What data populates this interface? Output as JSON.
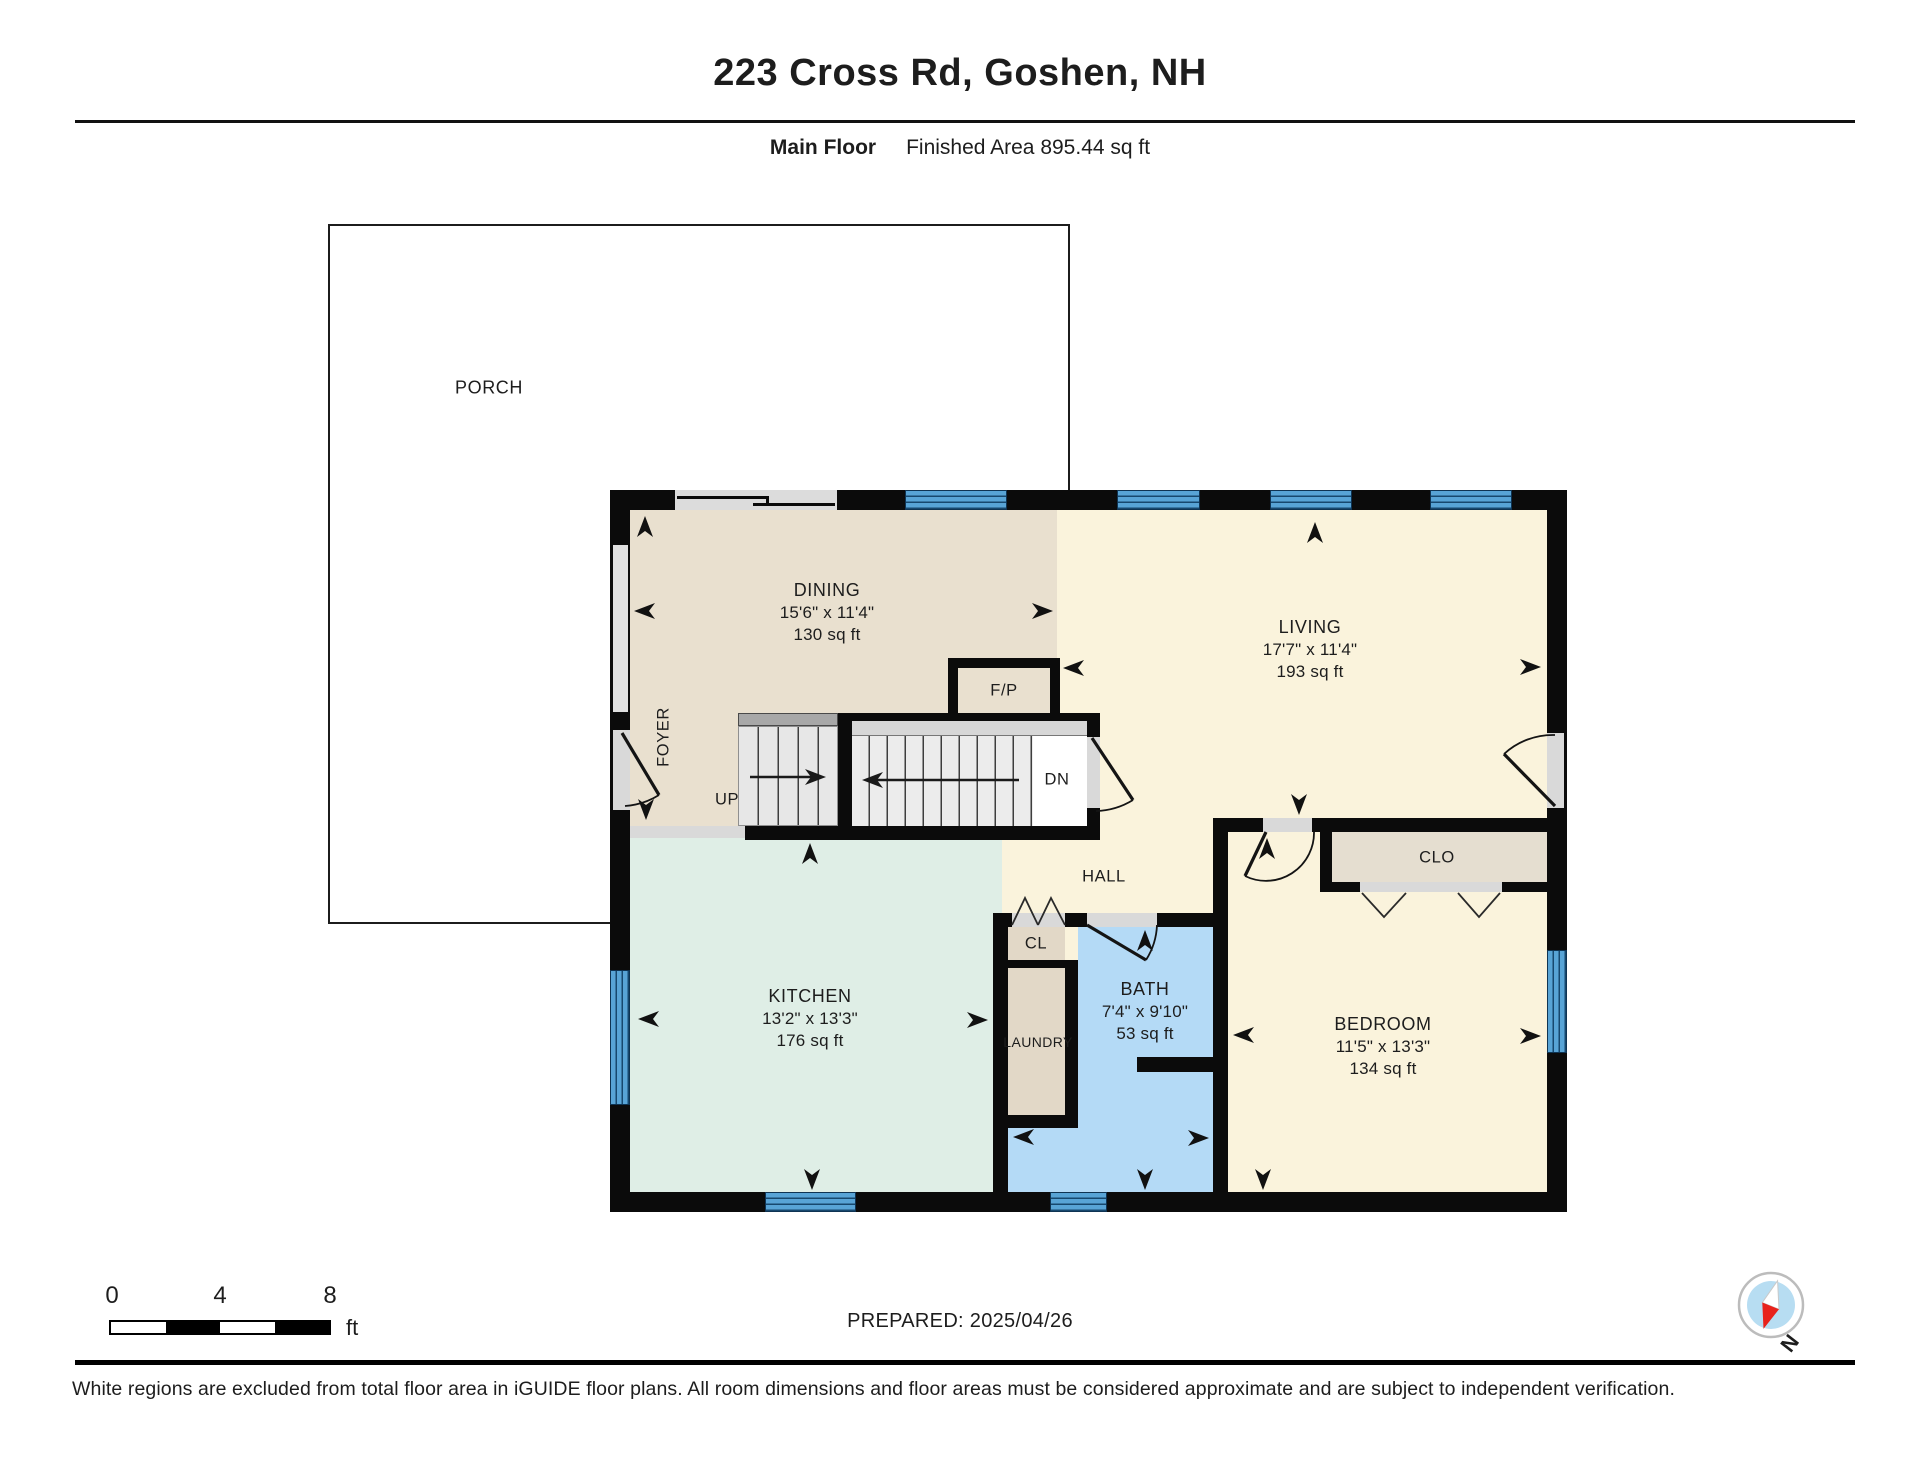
{
  "header": {
    "title": "223 Cross Rd, Goshen, NH",
    "floor_label": "Main Floor",
    "area_label": "Finished Area 895.44 sq ft"
  },
  "rooms": {
    "porch": {
      "name": "PORCH"
    },
    "dining": {
      "name": "DINING",
      "dims": "15'6\" x 11'4\"",
      "area": "130 sq ft"
    },
    "living": {
      "name": "LIVING",
      "dims": "17'7\" x 11'4\"",
      "area": "193 sq ft"
    },
    "kitchen": {
      "name": "KITCHEN",
      "dims": "13'2\" x 13'3\"",
      "area": "176 sq ft"
    },
    "bath": {
      "name": "BATH",
      "dims": "7'4\" x 9'10\"",
      "area": "53 sq ft"
    },
    "bedroom": {
      "name": "BEDROOM",
      "dims": "11'5\" x 13'3\"",
      "area": "134 sq ft"
    },
    "foyer": {
      "name": "FOYER"
    },
    "hall": {
      "name": "HALL"
    },
    "laundry": {
      "name": "LAUNDRY"
    },
    "closet_hall": {
      "name": "CL"
    },
    "closet_bedroom": {
      "name": "CLO"
    },
    "fireplace": {
      "name": "F/P"
    },
    "stairs_up": {
      "name": "UP"
    },
    "stairs_down": {
      "name": "DN"
    }
  },
  "scale_bar": {
    "tick0": "0",
    "tick4": "4",
    "tick8": "8",
    "unit": "ft"
  },
  "compass": {
    "north_label": "N"
  },
  "footer": {
    "prepared": "PREPARED: 2025/04/26",
    "disclaimer": "White regions are excluded from total floor area in iGUIDE floor plans. All room dimensions and floor areas must be considered approximate and are subject to independent verification."
  },
  "colors": {
    "dining_beige": "#e9e0cf",
    "living_cream": "#faf3dc",
    "kitchen_mint": "#dfeee6",
    "bath_blue": "#b4daf6",
    "closet_tan": "#e2d8c7",
    "clo_tan": "#e5ded0",
    "window_blue": "#58a4d6",
    "wall_black": "#0b0b0b",
    "compass_red": "#e8221c",
    "compass_blue": "#b7ddf2"
  }
}
